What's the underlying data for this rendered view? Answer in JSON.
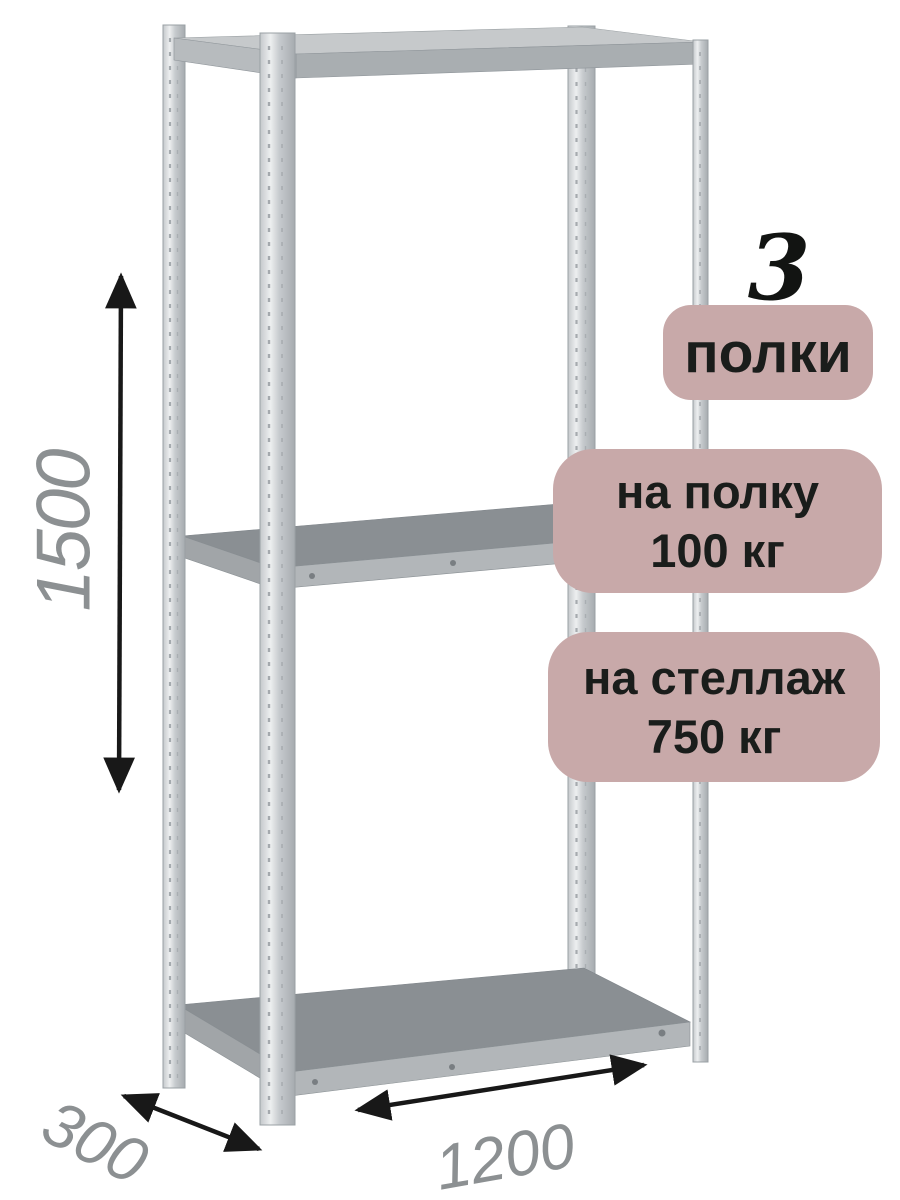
{
  "page": {
    "background": "#ffffff",
    "description": "Product render of a metal boltless shelving rack with dimension callouts and load-capacity badges"
  },
  "rack": {
    "shelf_count_number": "3",
    "shelf_count_label": "полки"
  },
  "capacity_badges": {
    "per_shelf_line1": "на полку",
    "per_shelf_line2": "100 кг",
    "per_rack_line1": "на стеллаж",
    "per_rack_line2": "750 кг"
  },
  "dimensions": {
    "height": "1500",
    "depth": "300",
    "width": "1200"
  },
  "icons": {
    "height_arrow": "double-headed-vertical-arrow",
    "depth_arrow": "double-headed-diagonal-arrow",
    "width_arrow": "double-headed-diagonal-arrow"
  },
  "colors": {
    "badge_background": "#c8a9a9",
    "badge_text": "#1a1d1b",
    "count_text": "#121412",
    "dimension_label": "#8c9092",
    "arrow": "#181818",
    "metal_light": "#edeff0",
    "metal_dark": "#a6abaf",
    "shelf_surface": "#8a8f93",
    "shelf_front_edge": "#b2b6b9"
  }
}
